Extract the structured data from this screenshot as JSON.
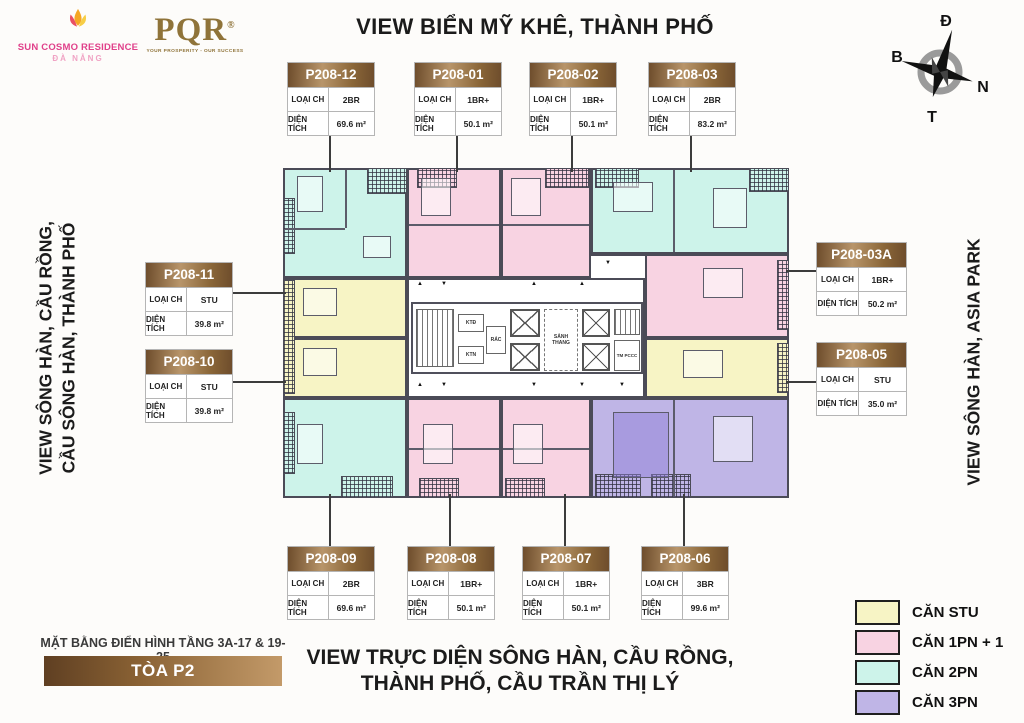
{
  "brand": {
    "name": "SUN COSMO RESIDENCE",
    "city": "ĐÀ NẴNG"
  },
  "agency": {
    "name": "PQR",
    "reg": "®",
    "tagline": "YOUR PROSPERITY - OUR SUCCESS"
  },
  "views": {
    "top": "VIEW BIỂN MỸ KHÊ, THÀNH PHỐ",
    "left_line1": "VIEW SÔNG HÀN, CẦU RỒNG,",
    "left_line2": "CẦU SÔNG HÀN, THÀNH PHỐ",
    "right": "VIEW SÔNG HÀN, ASIA PARK",
    "bottom_line1": "VIEW TRỰC DIỆN SÔNG HÀN, CẦU RỒNG,",
    "bottom_line2": "THÀNH PHỐ, CẦU TRẦN THỊ LÝ"
  },
  "compass": {
    "top": "Đ",
    "left": "B",
    "right": "N",
    "bottom": "T"
  },
  "floor_info": {
    "caption": "MẶT BẰNG ĐIỂN HÌNH TẦNG 3A-17 & 19-25",
    "tower": "TÒA P2"
  },
  "card_labels": {
    "type": "LOẠI CH",
    "area": "DIỆN TÍCH"
  },
  "units": [
    {
      "id": "P208-12",
      "type": "2BR",
      "area": "69.6 m²"
    },
    {
      "id": "P208-01",
      "type": "1BR+",
      "area": "50.1 m²"
    },
    {
      "id": "P208-02",
      "type": "1BR+",
      "area": "50.1 m²"
    },
    {
      "id": "P208-03",
      "type": "2BR",
      "area": "83.2 m²"
    },
    {
      "id": "P208-03A",
      "type": "1BR+",
      "area": "50.2 m²"
    },
    {
      "id": "P208-05",
      "type": "STU",
      "area": "35.0 m²"
    },
    {
      "id": "P208-11",
      "type": "STU",
      "area": "39.8 m²"
    },
    {
      "id": "P208-10",
      "type": "STU",
      "area": "39.8 m²"
    },
    {
      "id": "P208-09",
      "type": "2BR",
      "area": "69.6 m²"
    },
    {
      "id": "P208-08",
      "type": "1BR+",
      "area": "50.1 m²"
    },
    {
      "id": "P208-07",
      "type": "1BR+",
      "area": "50.1 m²"
    },
    {
      "id": "P208-06",
      "type": "3BR",
      "area": "99.6 m²"
    }
  ],
  "legend": [
    {
      "label": "CĂN STU",
      "color": "#f7f4c5"
    },
    {
      "label": "CĂN 1PN + 1",
      "color": "#f8d3e2"
    },
    {
      "label": "CĂN 2PN",
      "color": "#cdf3ea"
    },
    {
      "label": "CĂN 3PN",
      "color": "#bfb5e6"
    }
  ],
  "core": {
    "lobby": "SẢNH THANG",
    "fire": "TM PCCC",
    "trash": "RÁC",
    "ktd": "KTĐ",
    "ktn": "KTN"
  },
  "icons": {
    "arrow_up": "▲",
    "arrow_down": "▼"
  }
}
